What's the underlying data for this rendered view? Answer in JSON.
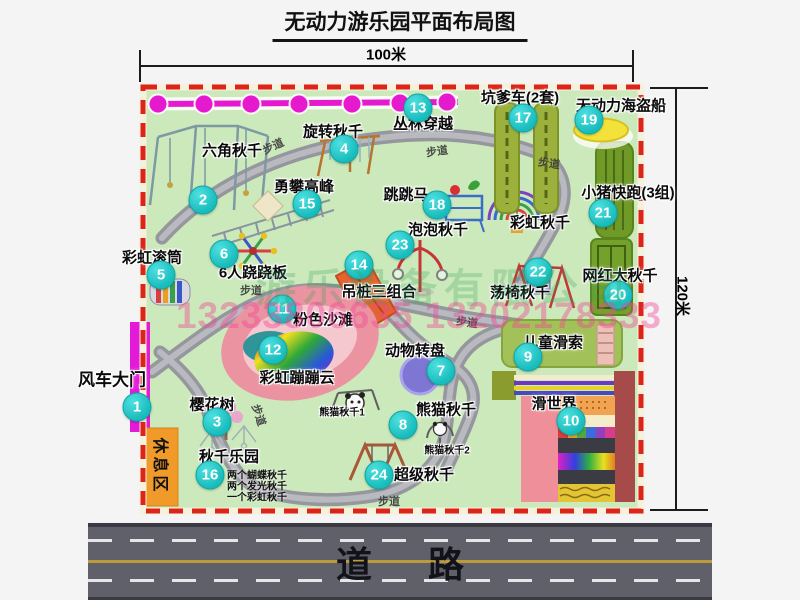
{
  "title": "无动力游乐园平面布局图",
  "dimensions": {
    "width": "100米",
    "height": "120米"
  },
  "road": {
    "label": "道 路"
  },
  "watermark": {
    "company": "游乐设备有限公司",
    "phone": "13233806635 13202178333"
  },
  "zones": {
    "rest_area": "休息区",
    "walkway": "步道"
  },
  "extra_labels": {
    "rainbow_swing": "彩虹秋千",
    "panda_swing_1": "熊猫秋千1",
    "panda_swing_2": "熊猫秋千2"
  },
  "swing_park_notes": [
    "两个蝴蝶秋千",
    "两个发光秋千",
    "一个彩虹秋千"
  ],
  "attractions": [
    {
      "num": "1",
      "label": "风车大门"
    },
    {
      "num": "2",
      "label": "六角秋千"
    },
    {
      "num": "3",
      "label": "樱花树"
    },
    {
      "num": "4",
      "label": "旋转秋千"
    },
    {
      "num": "5",
      "label": "彩虹滚筒"
    },
    {
      "num": "6",
      "label": "6人跷跷板"
    },
    {
      "num": "7",
      "label": "动物转盘"
    },
    {
      "num": "8",
      "label": "熊猫秋千"
    },
    {
      "num": "9",
      "label": "儿童滑索"
    },
    {
      "num": "10",
      "label": "滑世界"
    },
    {
      "num": "11",
      "label": "粉色沙滩"
    },
    {
      "num": "12",
      "label": "彩虹蹦蹦云"
    },
    {
      "num": "13",
      "label": "丛林穿越"
    },
    {
      "num": "14",
      "label": "吊桩三组合"
    },
    {
      "num": "15",
      "label": "勇攀高峰"
    },
    {
      "num": "16",
      "label": "秋千乐园"
    },
    {
      "num": "17",
      "label": "坑爹车(2套)"
    },
    {
      "num": "18",
      "label": "跳跳马"
    },
    {
      "num": "19",
      "label": "无动力海盗船"
    },
    {
      "num": "20",
      "label": "网红大秋千"
    },
    {
      "num": "21",
      "label": "小猪快跑(3组)"
    },
    {
      "num": "22",
      "label": "荡椅秋千"
    },
    {
      "num": "23",
      "label": "泡泡秋千"
    },
    {
      "num": "24",
      "label": "超级秋千"
    }
  ]
}
